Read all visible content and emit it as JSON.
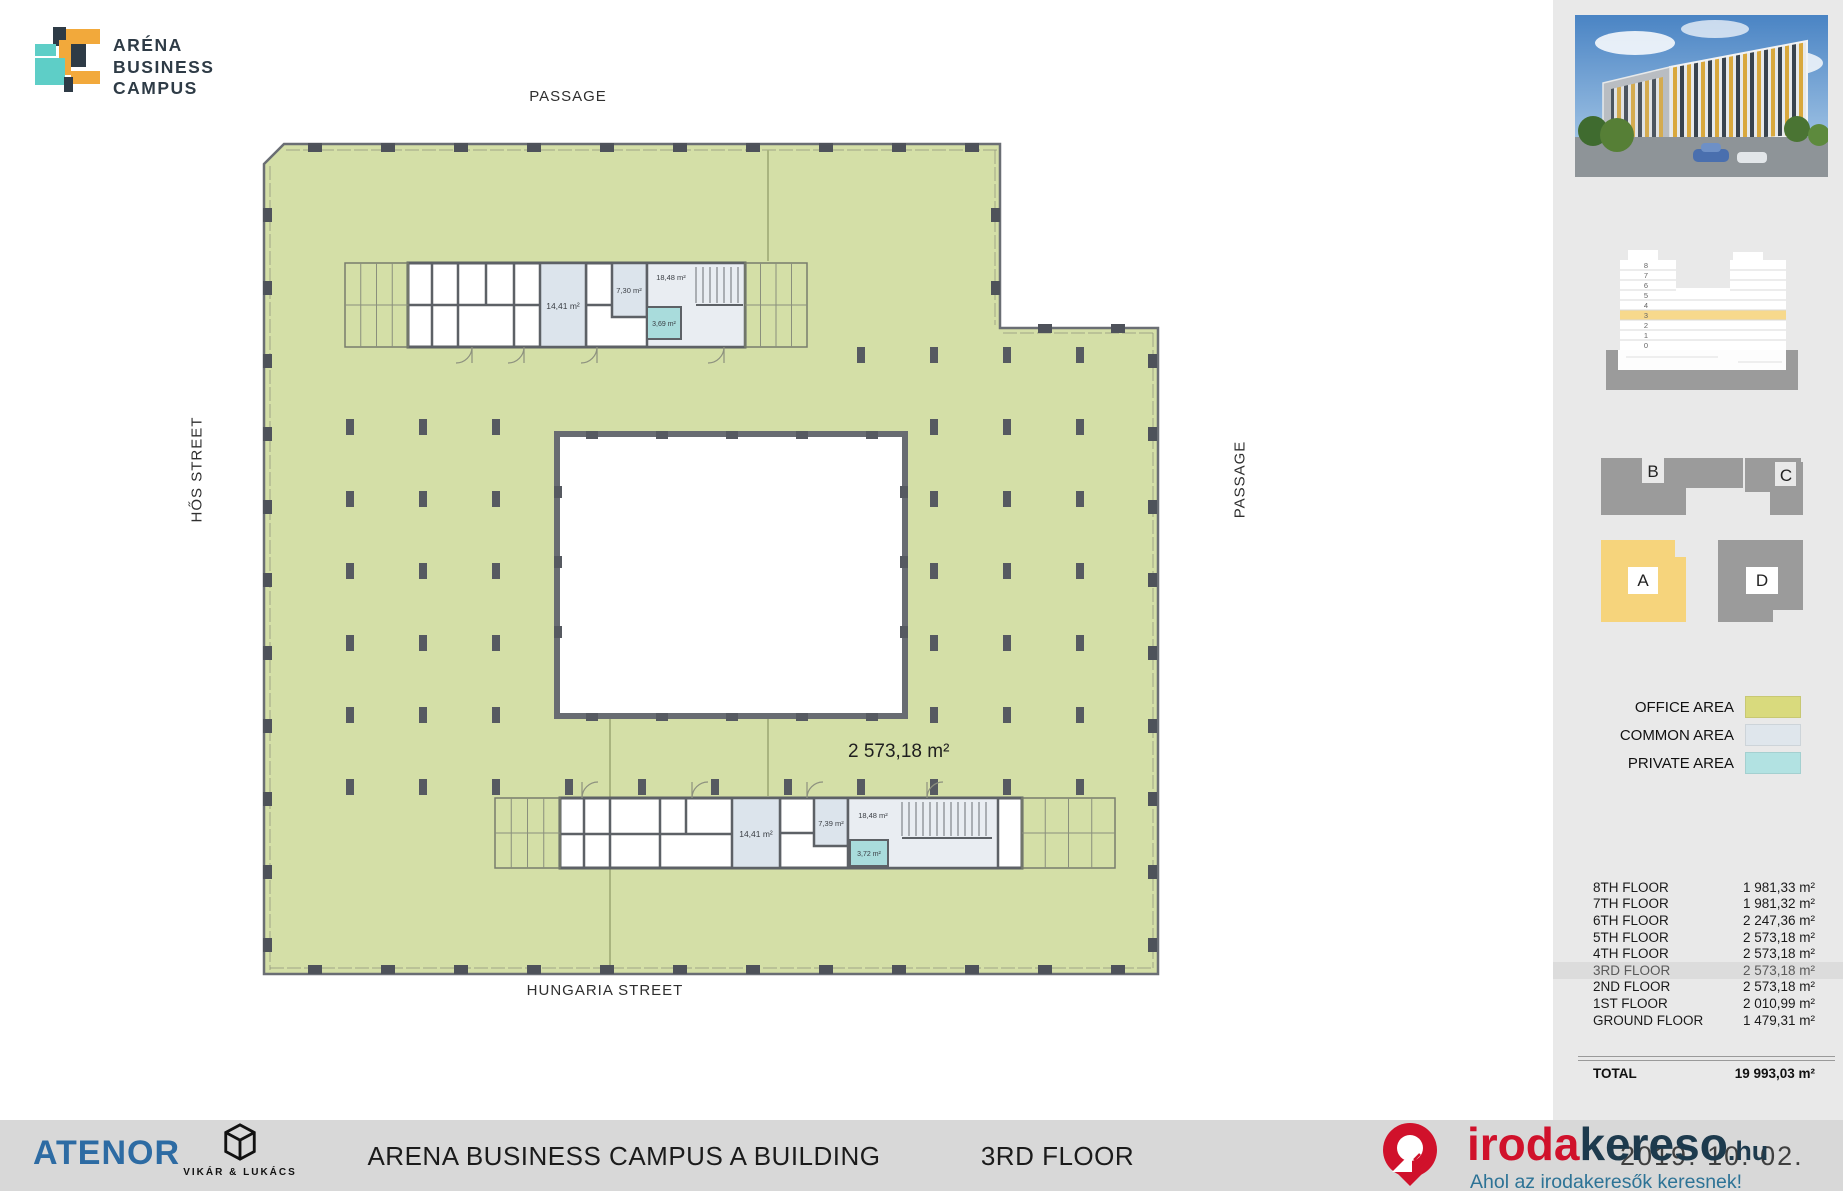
{
  "logo": {
    "title_lines": [
      "ARÉNA",
      "BUSINESS",
      "CAMPUS"
    ],
    "colors": {
      "teal": "#5ecec7",
      "orange": "#f2a93b",
      "navy": "#2e3b46"
    }
  },
  "plan": {
    "street_top": "PASSAGE",
    "street_left": "HŐS STREET",
    "street_right": "PASSAGE",
    "street_bottom": "HUNGARIA STREET",
    "office_area_label": "2 573,18 m²",
    "colors": {
      "office": "#d4dfa7",
      "common": "#dce4ec",
      "private": "#a9dcdc",
      "wall": "#5d6166"
    },
    "top_core_rooms": {
      "r1": "14,41 m²",
      "r2": "7,30 m²",
      "stairs": "18,48 m²",
      "wc": "3,69 m²"
    },
    "bottom_core_rooms": {
      "r1": "14,41 m²",
      "r2": "7,39 m²",
      "stairs": "18,48 m²",
      "wc": "3,72 m²"
    }
  },
  "sidebar": {
    "stack": {
      "floors": [
        "8",
        "7",
        "6",
        "5",
        "4",
        "3",
        "2",
        "1",
        "0"
      ],
      "highlighted_floor": "3",
      "highlight_color": "#f7d98c"
    },
    "site": {
      "b": "B",
      "c": "C",
      "a": "A",
      "d": "D",
      "highlighted_block": "A",
      "highlight_color": "#f6d47c"
    },
    "legend": {
      "items": [
        {
          "label": "OFFICE AREA",
          "color": "#d9da7d"
        },
        {
          "label": "COMMON AREA",
          "color": "#dfe6ec"
        },
        {
          "label": "PRIVATE AREA",
          "color": "#b2e2e2"
        }
      ]
    },
    "table": {
      "rows": [
        {
          "floor": "8TH FLOOR",
          "area": "1 981,33 m²"
        },
        {
          "floor": "7TH FLOOR",
          "area": "1 981,32 m²"
        },
        {
          "floor": "6TH FLOOR",
          "area": "2 247,36 m²"
        },
        {
          "floor": "5TH FLOOR",
          "area": "2 573,18 m²"
        },
        {
          "floor": "4TH FLOOR",
          "area": "2 573,18 m²"
        },
        {
          "floor": "3RD FLOOR",
          "area": "2 573,18 m²"
        },
        {
          "floor": "2ND FLOOR",
          "area": "2 573,18 m²"
        },
        {
          "floor": "1ST FLOOR",
          "area": "2 010,99 m²"
        },
        {
          "floor": "GROUND FLOOR",
          "area": "1 479,31 m²"
        }
      ],
      "highlighted_row": "3RD FLOOR",
      "total_label": "TOTAL",
      "total_value": "19 993,03 m²"
    }
  },
  "footer": {
    "developer_logo": "ATENOR",
    "architect_name": "VIKÁR & LUKÁCS",
    "title": "ARENA BUSINESS CAMPUS A BUILDING",
    "floor_label": "3RD FLOOR",
    "date": "2019. 10. 02."
  },
  "watermark": {
    "part1": "iroda",
    "part2": "kereso",
    "part3": ".hu",
    "tagline": "Ahol az irodakeresők keresnek!",
    "red": "#d0112b",
    "navy": "#1d3a4d",
    "blue": "#2d7396"
  }
}
